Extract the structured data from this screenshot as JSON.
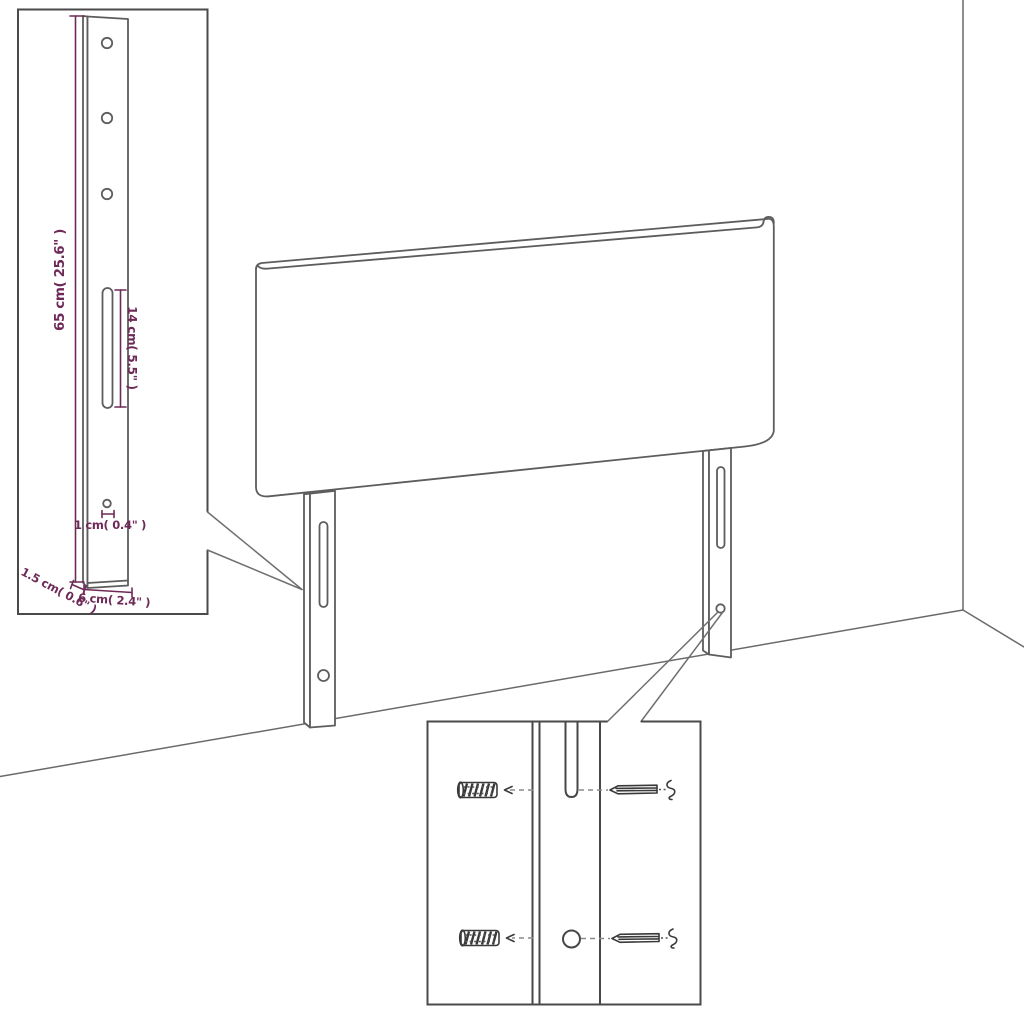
{
  "figure": {
    "type": "furniture-assembly-diagram",
    "subject": "headboard with two mounting brackets standing in a room corner"
  },
  "colors": {
    "background": "#ffffff",
    "outline": "#5d5d5d",
    "inset_frame": "#4a4a4a",
    "dimension": "#6e2a57"
  },
  "bracket_inset": {
    "dim_height": "65 cm( 25.6\" )",
    "dim_slot": "14 cm( 5.5\" )",
    "dim_hole": "1 cm( 0.4\" )",
    "dim_thickness": "1.5 cm( 0.6\" )",
    "dim_width": "6 cm( 2.4\" )"
  },
  "hardware_inset": {
    "parts": [
      "wall-plug",
      "screw",
      "wall-plug",
      "screw"
    ]
  }
}
